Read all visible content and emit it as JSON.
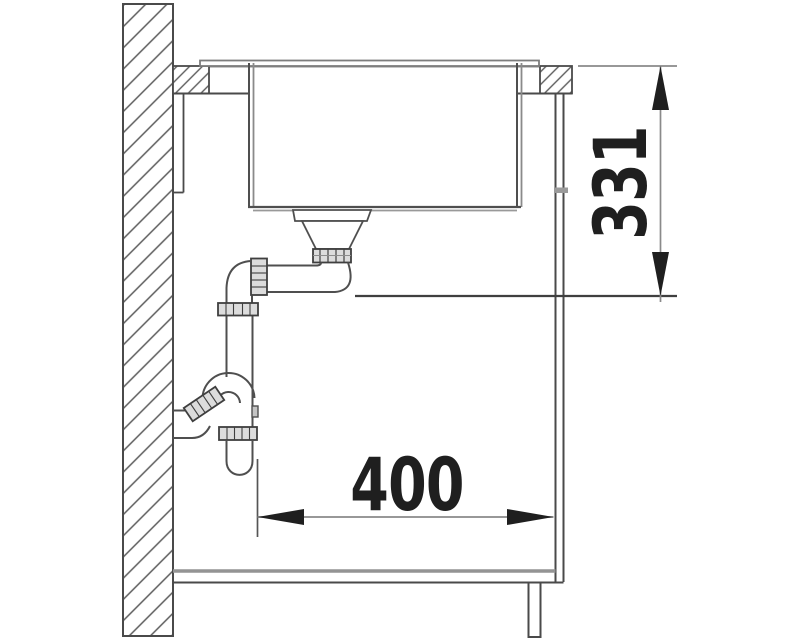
{
  "drawing": {
    "type": "sink-installation-side-section",
    "dimension_labels": {
      "vertical": "331",
      "horizontal": "400"
    }
  },
  "colors": {
    "background": "#ffffff",
    "outline": "#4f4f4f",
    "light_line": "#8d8d8d",
    "dimension_line": "#8a8a8a",
    "arrow_and_text": "#1f1f1f",
    "fitting_fill": "#dcdcdc",
    "hatch_line": "#5c5c5c"
  }
}
